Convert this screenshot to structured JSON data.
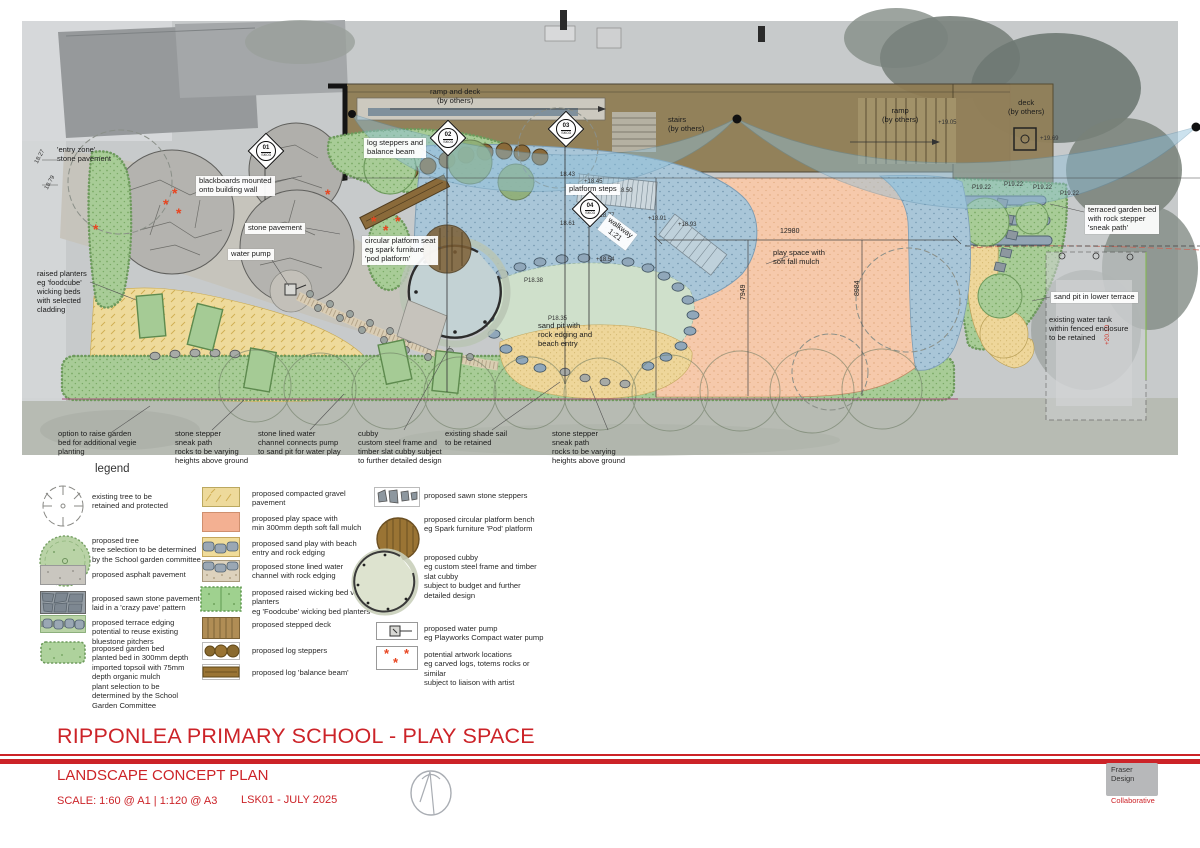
{
  "title_block": {
    "project_title": "RIPPONLEA PRIMARY SCHOOL - PLAY SPACE",
    "drawing_title": "LANDSCAPE CONCEPT PLAN",
    "scale": "SCALE: 1:60 @ A1 | 1:120 @ A3",
    "sheet_number": "LSK01 - JULY 2025",
    "logo": {
      "line1": "Fraser",
      "line2": "Design",
      "line3": "Collaborative"
    }
  },
  "legend": {
    "heading": "legend",
    "col1": [
      "existing tree to be\nretained and protected",
      "proposed tree\ntree selection to be determined\n by the School garden committee",
      "proposed asphalt pavement",
      "proposed sawn stone pavement\nlaid in a 'crazy pave' pattern",
      "proposed terrace edging\npotential to reuse existing\nbluestone pitchers",
      "proposed garden bed\nplanted bed in 300mm depth\nimported topsoil with 75mm\ndepth organic mulch\nplant selection to be\ndetermined by the School\nGarden Committee"
    ],
    "col2": [
      "proposed compacted gravel\npavement",
      "proposed play space with\nmin 300mm depth soft fall mulch",
      "proposed sand play with beach\nentry and rock edging",
      "proposed stone lined water\nchannel with rock edging",
      "proposed raised wicking bed vegie\nplanters\neg 'Foodcube' wicking bed planters",
      "proposed stepped deck",
      "proposed log steppers",
      "proposed log 'balance beam'"
    ],
    "col3": [
      "proposed sawn stone steppers",
      "proposed circular platform bench\neg Spark furniture 'Pod' platform",
      "proposed cubby\neg custom steel frame and timber\nslat cubby\nsubject to budget and further\ndetailed design",
      "proposed water pump\neg Playworks Compact water pump",
      "potential artwork locations\neg carved logs, totems rocks or\nsimilar\nsubject to liaison with artist"
    ]
  },
  "plan": {
    "labels": [
      "'entry zone'\nstone pavement",
      "blackboards mounted\nonto building wall",
      "stone pavement",
      "water pump",
      "raised planters\neg 'foodcube'\nwicking beds\nwith selected\ncladding",
      "log steppers and\nbalance beam",
      "circular platform seat\neg spark furniture\n'pod platform'",
      "ramp and deck\n(by others)",
      "stairs\n(by others)",
      "platform steps",
      "walkway\n1:21",
      "sand pit with\nrock edging and\nbeach entry",
      "play space with\nsoft fall mulch",
      "ramp\n(by others)",
      "deck\n(by others)",
      "terraced garden bed\nwith rock stepper\n'sneak path'",
      "sand pit in lower terrace",
      "existing water tank\nwithin fenced enclosure\nto be retained",
      "option to raise garden\nbed for additional vegie\nplanting",
      "stone stepper\nsneak path\nrocks to be varying\nheights above ground",
      "stone lined water\nchannel connects pump\nto sand pit for water play",
      "cubby\ncustom steel frame and\ntimber slat cubby subject\nto further detailed design",
      "existing shade sail\nto be retained",
      "stone stepper\nsneak path\nrocks to be varying\nheights above ground"
    ],
    "dimensions": {
      "width": "12980",
      "depth_left": "7949",
      "depth_right": "8984"
    },
    "levels": [
      "18.27",
      "18.79",
      "18.43",
      "+18.45",
      "+18.50",
      "+18.77",
      "+18.91",
      "+18.93",
      "18.61",
      "+18.54",
      "P18.38",
      "P18.35",
      "+19.05",
      "+19.69",
      "P19.22",
      "P19.22",
      "P19.22",
      "P19.22",
      "+20.10"
    ],
    "markers": [
      {
        "num": "01",
        "sheet": "SK03"
      },
      {
        "num": "02",
        "sheet": "SK03"
      },
      {
        "num": "03",
        "sheet": "SK03"
      },
      {
        "num": "04",
        "sheet": "SK03"
      }
    ],
    "artwork_symbol": "*"
  },
  "colors": {
    "accent_red": "#cc2328",
    "artwork_red": "#e8441f",
    "play_space_mulch": "#f6c9ab",
    "sand": "#eed69a",
    "compacted_gravel": "#eeda9b",
    "garden_bed": "#a5cb95",
    "walkway_blue": "#a9c6d8",
    "deck_brown": "#8f7c52",
    "stone_grey": "#b4b3af",
    "rock_edging": "#90a7ba"
  }
}
